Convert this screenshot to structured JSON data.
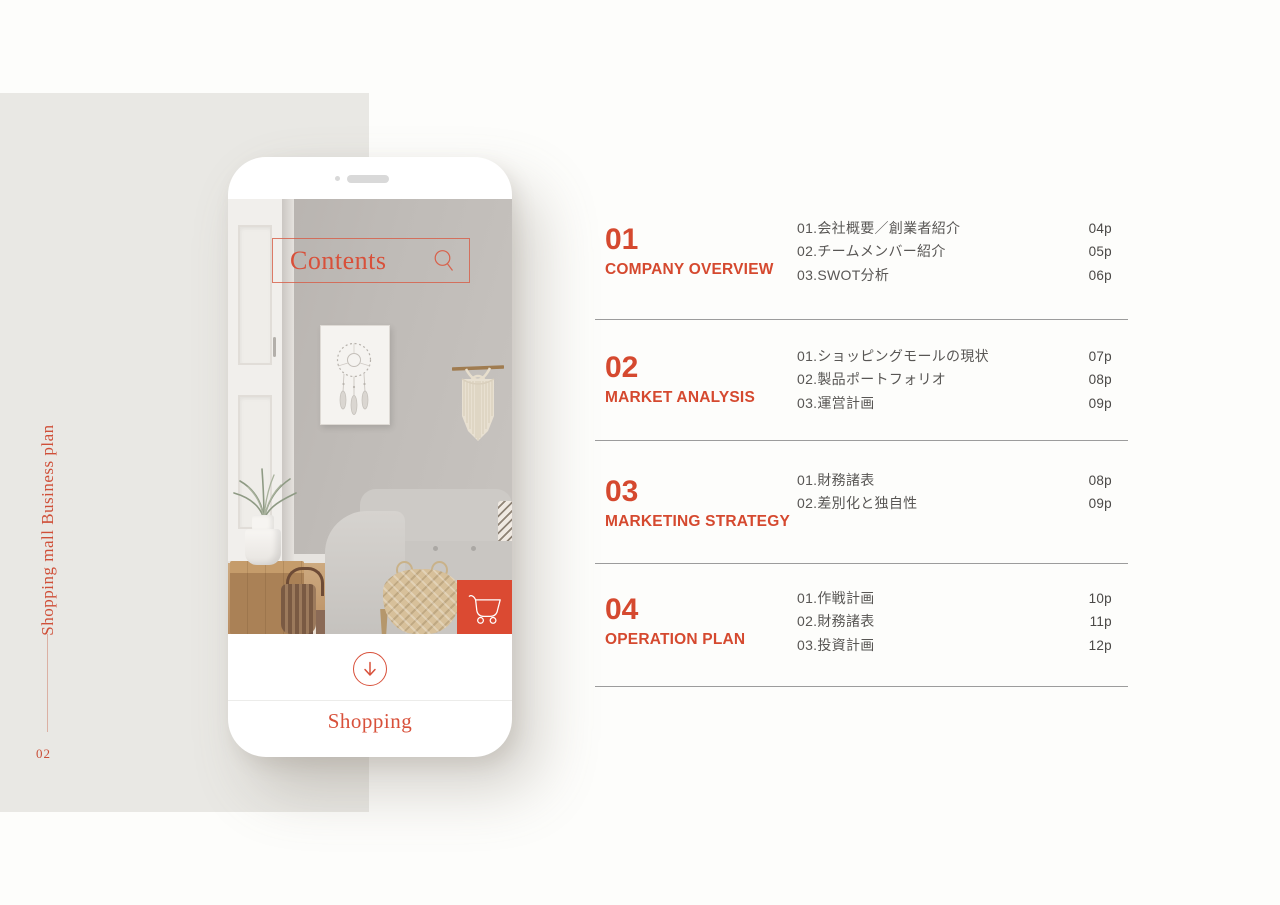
{
  "colors": {
    "accent": "#D5492F",
    "cart_bg": "#DB4A32",
    "panel": "#E9E8E4"
  },
  "sidebar": {
    "vertical_title": "Shopping mall Business plan",
    "page_number": "02"
  },
  "phone": {
    "search_label": "Contents",
    "bottom_label": "Shopping",
    "icons": [
      "magnifier-icon",
      "shopping-cart-icon",
      "arrow-down-icon",
      "camera-dot",
      "speaker-bar"
    ]
  },
  "toc": {
    "sections": [
      {
        "number": "01",
        "title": "COMPANY OVERVIEW",
        "items": [
          {
            "label": "01.会社概要／創業者紹介",
            "page": "04p"
          },
          {
            "label": "02.チームメンバー紹介",
            "page": "05p"
          },
          {
            "label": "03.SWOT分析",
            "page": "06p"
          }
        ]
      },
      {
        "number": "02",
        "title": "MARKET ANALYSIS",
        "items": [
          {
            "label": "01.ショッピングモールの現状",
            "page": "07p"
          },
          {
            "label": "02.製品ポートフォリオ",
            "page": "08p"
          },
          {
            "label": "03.運営計画",
            "page": "09p"
          }
        ]
      },
      {
        "number": "03",
        "title": "MARKETING STRATEGY",
        "items": [
          {
            "label": "01.財務諸表",
            "page": "08p"
          },
          {
            "label": "02.差別化と独自性",
            "page": "09p"
          }
        ]
      },
      {
        "number": "04",
        "title": "OPERATION PLAN",
        "items": [
          {
            "label": "01.作戦計画",
            "page": "10p"
          },
          {
            "label": "02.財務諸表",
            "page": "11p"
          },
          {
            "label": "03.投資計画",
            "page": "12p"
          }
        ]
      }
    ]
  }
}
